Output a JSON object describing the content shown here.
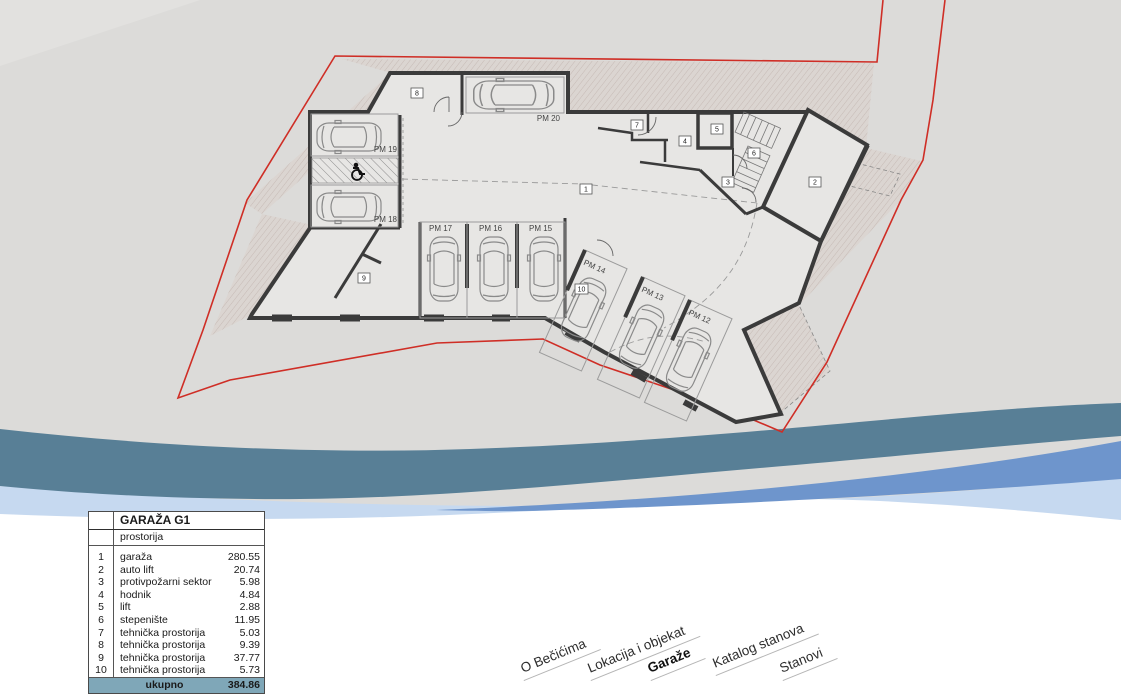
{
  "plan": {
    "parking": {
      "pm20": "PM 20",
      "pm19": "PM 19",
      "pm18": "PM 18",
      "pm17": "PM 17",
      "pm16": "PM 16",
      "pm15": "PM 15",
      "pm14": "PM 14",
      "pm13": "PM 13",
      "pm12": "PM 12"
    },
    "rooms": {
      "r1": "1",
      "r2": "2",
      "r3": "3",
      "r4": "4",
      "r5": "5",
      "r6": "6",
      "r7": "7",
      "r8": "8",
      "r9": "9",
      "r10": "10"
    },
    "icons": [
      "wheelchair-icon"
    ]
  },
  "table": {
    "title": "GARAŽA G1",
    "subtitle": "prostorija",
    "rows": [
      {
        "num": "1",
        "name": "garaža",
        "area": "280.55"
      },
      {
        "num": "2",
        "name": "auto lift",
        "area": "20.74"
      },
      {
        "num": "3",
        "name": "protivpožarni sektor",
        "area": "5.98"
      },
      {
        "num": "4",
        "name": "hodnik",
        "area": "4.84"
      },
      {
        "num": "5",
        "name": "lift",
        "area": "2.88"
      },
      {
        "num": "6",
        "name": "stepenište",
        "area": "11.95"
      },
      {
        "num": "7",
        "name": "tehnička prostorija",
        "area": "5.03"
      },
      {
        "num": "8",
        "name": "tehnička prostorija",
        "area": "9.39"
      },
      {
        "num": "9",
        "name": "tehnička prostorija",
        "area": "37.77"
      },
      {
        "num": "10",
        "name": "tehnička prostorija",
        "area": "5.73"
      }
    ],
    "total_label": "ukupno",
    "total_value": "384.86"
  },
  "nav": {
    "items": [
      {
        "label": "O Bečićima",
        "active": false
      },
      {
        "label": "Lokacija i objekat",
        "active": false
      },
      {
        "label": "Garaže",
        "active": true
      },
      {
        "label": "Katalog stanova",
        "active": false
      },
      {
        "label": "Stanovi",
        "active": false
      }
    ]
  },
  "colors": {
    "page_gray": "#dcdbd9",
    "boundary_red": "#cf2e26",
    "wave_teal": "#587f96",
    "wave_blue": "#6e95cc",
    "wave_light_blue": "#c6d9f0",
    "table_total_bg": "#7fa7b8",
    "wall": "#3b3b3b"
  }
}
